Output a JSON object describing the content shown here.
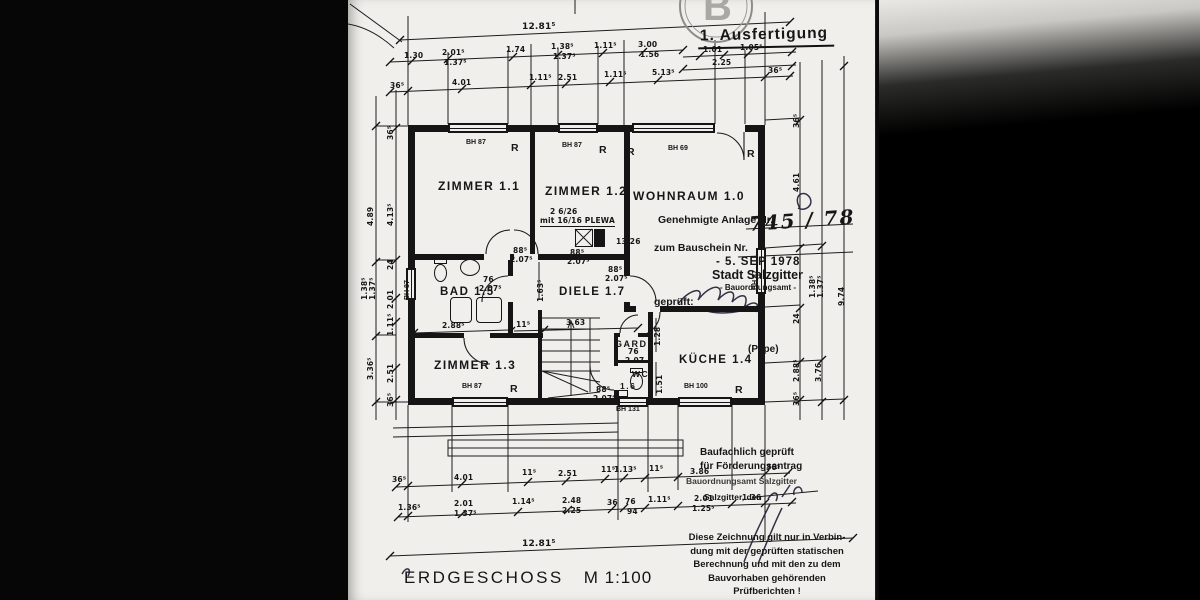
{
  "page": {
    "copy_label": "1. Ausfertigung",
    "stamp_letter": "B",
    "title": "ERDGESCHOSS",
    "scale": "M 1:100"
  },
  "approval_stamp": {
    "line1": "Genehmigte Anlage Nr.",
    "line2": "zum Bauschein Nr.",
    "date": "- 5. SEP 1978",
    "city": "Stadt Salzgitter",
    "office": "- Bauordnungsamt -",
    "checked": "geprüft:",
    "name": "(Pape)"
  },
  "funding_stamp": {
    "line1": "Baufachlich geprüft",
    "line2": "für Förderungsantrag",
    "line3": "Bauordnungsamt Salzgitter",
    "line4": "Salzgitter, den"
  },
  "note_lines": {
    "l1": "Diese Zeichnung gilt nur in Verbin-",
    "l2": "dung mit der geprüften statischen",
    "l3": "Berechnung und mit den zu dem",
    "l4": "Bauvorhaben gehörenden",
    "l5": "Prüfberichten !"
  },
  "annotations": {
    "rooms": [
      {
        "t": "ZIMMER 1.1",
        "x": 90,
        "y": 179
      },
      {
        "t": "ZIMMER 1.2",
        "x": 197,
        "y": 184
      },
      {
        "t": "WOHNRAUM 1.0",
        "x": 285,
        "y": 189
      },
      {
        "t": "BAD 1.5",
        "x": 92,
        "y": 286,
        "s": 11.5
      },
      {
        "t": "DIELE 1.7",
        "x": 211,
        "y": 286,
        "s": 11.5
      },
      {
        "t": "ZIMMER 1.3",
        "x": 86,
        "y": 358
      },
      {
        "t": "GARD.",
        "x": 267,
        "y": 339,
        "s": 9
      },
      {
        "t": "WC",
        "x": 284,
        "y": 369,
        "s": 8.5
      },
      {
        "t": "1.6",
        "x": 272,
        "y": 381,
        "s": 8.5
      },
      {
        "t": "KÜCHE 1.4",
        "x": 331,
        "y": 354,
        "s": 11.5
      }
    ],
    "windows": [
      {
        "t": "BH 87",
        "x": 118,
        "y": 139
      },
      {
        "t": "BH 87",
        "x": 214,
        "y": 142
      },
      {
        "t": "BH 69",
        "x": 320,
        "y": 145
      },
      {
        "t": "BH 87",
        "x": 114,
        "y": 383
      },
      {
        "t": "BH 100",
        "x": 336,
        "y": 383
      },
      {
        "t": "BH 131",
        "x": 268,
        "y": 406
      },
      {
        "t": "BH 87",
        "x": 56,
        "y": 300,
        "r": -90
      },
      {
        "t": "BH 87",
        "x": 404,
        "y": 290,
        "r": -90
      }
    ],
    "rmarks": [
      {
        "t": "R",
        "x": 163,
        "y": 142
      },
      {
        "t": "R",
        "x": 251,
        "y": 144
      },
      {
        "t": "R",
        "x": 279,
        "y": 146
      },
      {
        "t": "R",
        "x": 399,
        "y": 148
      },
      {
        "t": "R",
        "x": 162,
        "y": 383
      },
      {
        "t": "R",
        "x": 387,
        "y": 384
      }
    ],
    "handwriting": [
      {
        "t": "745 / 78",
        "x": 400,
        "y": 212,
        "s": 20,
        "r": -4
      }
    ],
    "dims": [
      {
        "t": "12.81⁵",
        "x": 174,
        "y": 22,
        "s": 9
      },
      {
        "t": "1.30",
        "x": 56,
        "y": 51
      },
      {
        "t": "2.01⁵",
        "x": 94,
        "y": 48
      },
      {
        "t": "1.37⁵",
        "x": 96,
        "y": 58
      },
      {
        "t": "1.74",
        "x": 158,
        "y": 45
      },
      {
        "t": "1.38⁵",
        "x": 203,
        "y": 42
      },
      {
        "t": "1.37⁵",
        "x": 205,
        "y": 52
      },
      {
        "t": "1.11⁵",
        "x": 246,
        "y": 41
      },
      {
        "t": "3.00",
        "x": 290,
        "y": 40
      },
      {
        "t": "1.56",
        "x": 292,
        "y": 50
      },
      {
        "t": "1.01",
        "x": 355,
        "y": 45
      },
      {
        "t": "1.05⁵",
        "x": 392,
        "y": 43
      },
      {
        "t": "2.25",
        "x": 364,
        "y": 58
      },
      {
        "t": "36⁵",
        "x": 42,
        "y": 81
      },
      {
        "t": "4.01",
        "x": 104,
        "y": 78
      },
      {
        "t": "1.11⁵",
        "x": 181,
        "y": 73
      },
      {
        "t": "2.51",
        "x": 210,
        "y": 73
      },
      {
        "t": "1.11⁵",
        "x": 256,
        "y": 70
      },
      {
        "t": "5.13⁵",
        "x": 304,
        "y": 68
      },
      {
        "t": "36⁵",
        "x": 420,
        "y": 66
      },
      {
        "t": "4.89",
        "x": 18,
        "y": 226,
        "r": -90
      },
      {
        "t": "1.38⁵",
        "x": 12,
        "y": 300,
        "r": -90
      },
      {
        "t": "1.37⁵",
        "x": 20,
        "y": 300,
        "r": -90
      },
      {
        "t": "3.36⁵",
        "x": 18,
        "y": 380,
        "r": -90
      },
      {
        "t": "36⁵",
        "x": 38,
        "y": 140,
        "r": -90
      },
      {
        "t": "4.13⁵",
        "x": 38,
        "y": 226,
        "r": -90
      },
      {
        "t": "24",
        "x": 38,
        "y": 270,
        "r": -90
      },
      {
        "t": "2.01",
        "x": 38,
        "y": 309,
        "r": -90
      },
      {
        "t": "1.11⁵",
        "x": 38,
        "y": 336,
        "r": -90
      },
      {
        "t": "2.51",
        "x": 38,
        "y": 383,
        "r": -90
      },
      {
        "t": "36⁵",
        "x": 38,
        "y": 407,
        "r": -90
      },
      {
        "t": "36⁵",
        "x": 444,
        "y": 128,
        "r": -90
      },
      {
        "t": "4.61",
        "x": 444,
        "y": 192,
        "r": -90
      },
      {
        "t": "24",
        "x": 444,
        "y": 324,
        "r": -90
      },
      {
        "t": "2.88⁵",
        "x": 444,
        "y": 382,
        "r": -90
      },
      {
        "t": "36⁵",
        "x": 444,
        "y": 406,
        "r": -90
      },
      {
        "t": "1.38⁵",
        "x": 460,
        "y": 298,
        "r": -90
      },
      {
        "t": "1.37⁵",
        "x": 468,
        "y": 298,
        "r": -90
      },
      {
        "t": "3.76",
        "x": 466,
        "y": 382,
        "r": -90
      },
      {
        "t": "9.74",
        "x": 489,
        "y": 306,
        "r": -90
      },
      {
        "t": "2.88⁵",
        "x": 94,
        "y": 321
      },
      {
        "t": "11⁵",
        "x": 168,
        "y": 320
      },
      {
        "t": "3.63",
        "x": 218,
        "y": 318
      },
      {
        "t": "76",
        "x": 135,
        "y": 275
      },
      {
        "t": "2.07⁵",
        "x": 131,
        "y": 284
      },
      {
        "t": "88⁵",
        "x": 165,
        "y": 246
      },
      {
        "t": "2.07⁵",
        "x": 162,
        "y": 255
      },
      {
        "t": "88⁵",
        "x": 222,
        "y": 248
      },
      {
        "t": "2.07⁵",
        "x": 219,
        "y": 257
      },
      {
        "t": "88⁵",
        "x": 260,
        "y": 265
      },
      {
        "t": "2.07⁵",
        "x": 257,
        "y": 274
      },
      {
        "t": "76",
        "x": 280,
        "y": 347
      },
      {
        "t": "2.07",
        "x": 277,
        "y": 356
      },
      {
        "t": "88⁵",
        "x": 248,
        "y": 385
      },
      {
        "t": "2.07⁵",
        "x": 245,
        "y": 394
      },
      {
        "t": "13/26",
        "x": 268,
        "y": 237
      },
      {
        "t": "2 6/26",
        "x": 202,
        "y": 207
      },
      {
        "t": "mit 16/16 PLEWA",
        "x": 192,
        "y": 216,
        "c": "u"
      },
      {
        "t": "1.63⁵",
        "x": 188,
        "y": 302,
        "r": -90
      },
      {
        "t": "1.28",
        "x": 305,
        "y": 346,
        "r": -90
      },
      {
        "t": "1.51",
        "x": 307,
        "y": 394,
        "r": -90
      },
      {
        "t": "36⁵",
        "x": 44,
        "y": 475
      },
      {
        "t": "4.01",
        "x": 106,
        "y": 473
      },
      {
        "t": "11⁵",
        "x": 174,
        "y": 468
      },
      {
        "t": "2.51",
        "x": 210,
        "y": 469
      },
      {
        "t": "11⁵",
        "x": 253,
        "y": 465
      },
      {
        "t": "1.13⁵",
        "x": 266,
        "y": 465
      },
      {
        "t": "11⁵",
        "x": 301,
        "y": 464
      },
      {
        "t": "3.86",
        "x": 342,
        "y": 467
      },
      {
        "t": "36⁵",
        "x": 418,
        "y": 463
      },
      {
        "t": "1.36⁵",
        "x": 50,
        "y": 503
      },
      {
        "t": "2.01",
        "x": 106,
        "y": 499
      },
      {
        "t": "1.37⁵",
        "x": 106,
        "y": 509
      },
      {
        "t": "1.14⁵",
        "x": 164,
        "y": 497
      },
      {
        "t": "2.48",
        "x": 214,
        "y": 496
      },
      {
        "t": "2.25",
        "x": 214,
        "y": 506
      },
      {
        "t": "36",
        "x": 259,
        "y": 498
      },
      {
        "t": "76",
        "x": 277,
        "y": 497
      },
      {
        "t": "94",
        "x": 279,
        "y": 507
      },
      {
        "t": "1.11⁵",
        "x": 300,
        "y": 495
      },
      {
        "t": "2.01",
        "x": 346,
        "y": 494
      },
      {
        "t": "1.25⁵",
        "x": 344,
        "y": 504
      },
      {
        "t": "1.36",
        "x": 394,
        "y": 493
      },
      {
        "t": "12.81⁵",
        "x": 174,
        "y": 539,
        "s": 9
      }
    ]
  }
}
